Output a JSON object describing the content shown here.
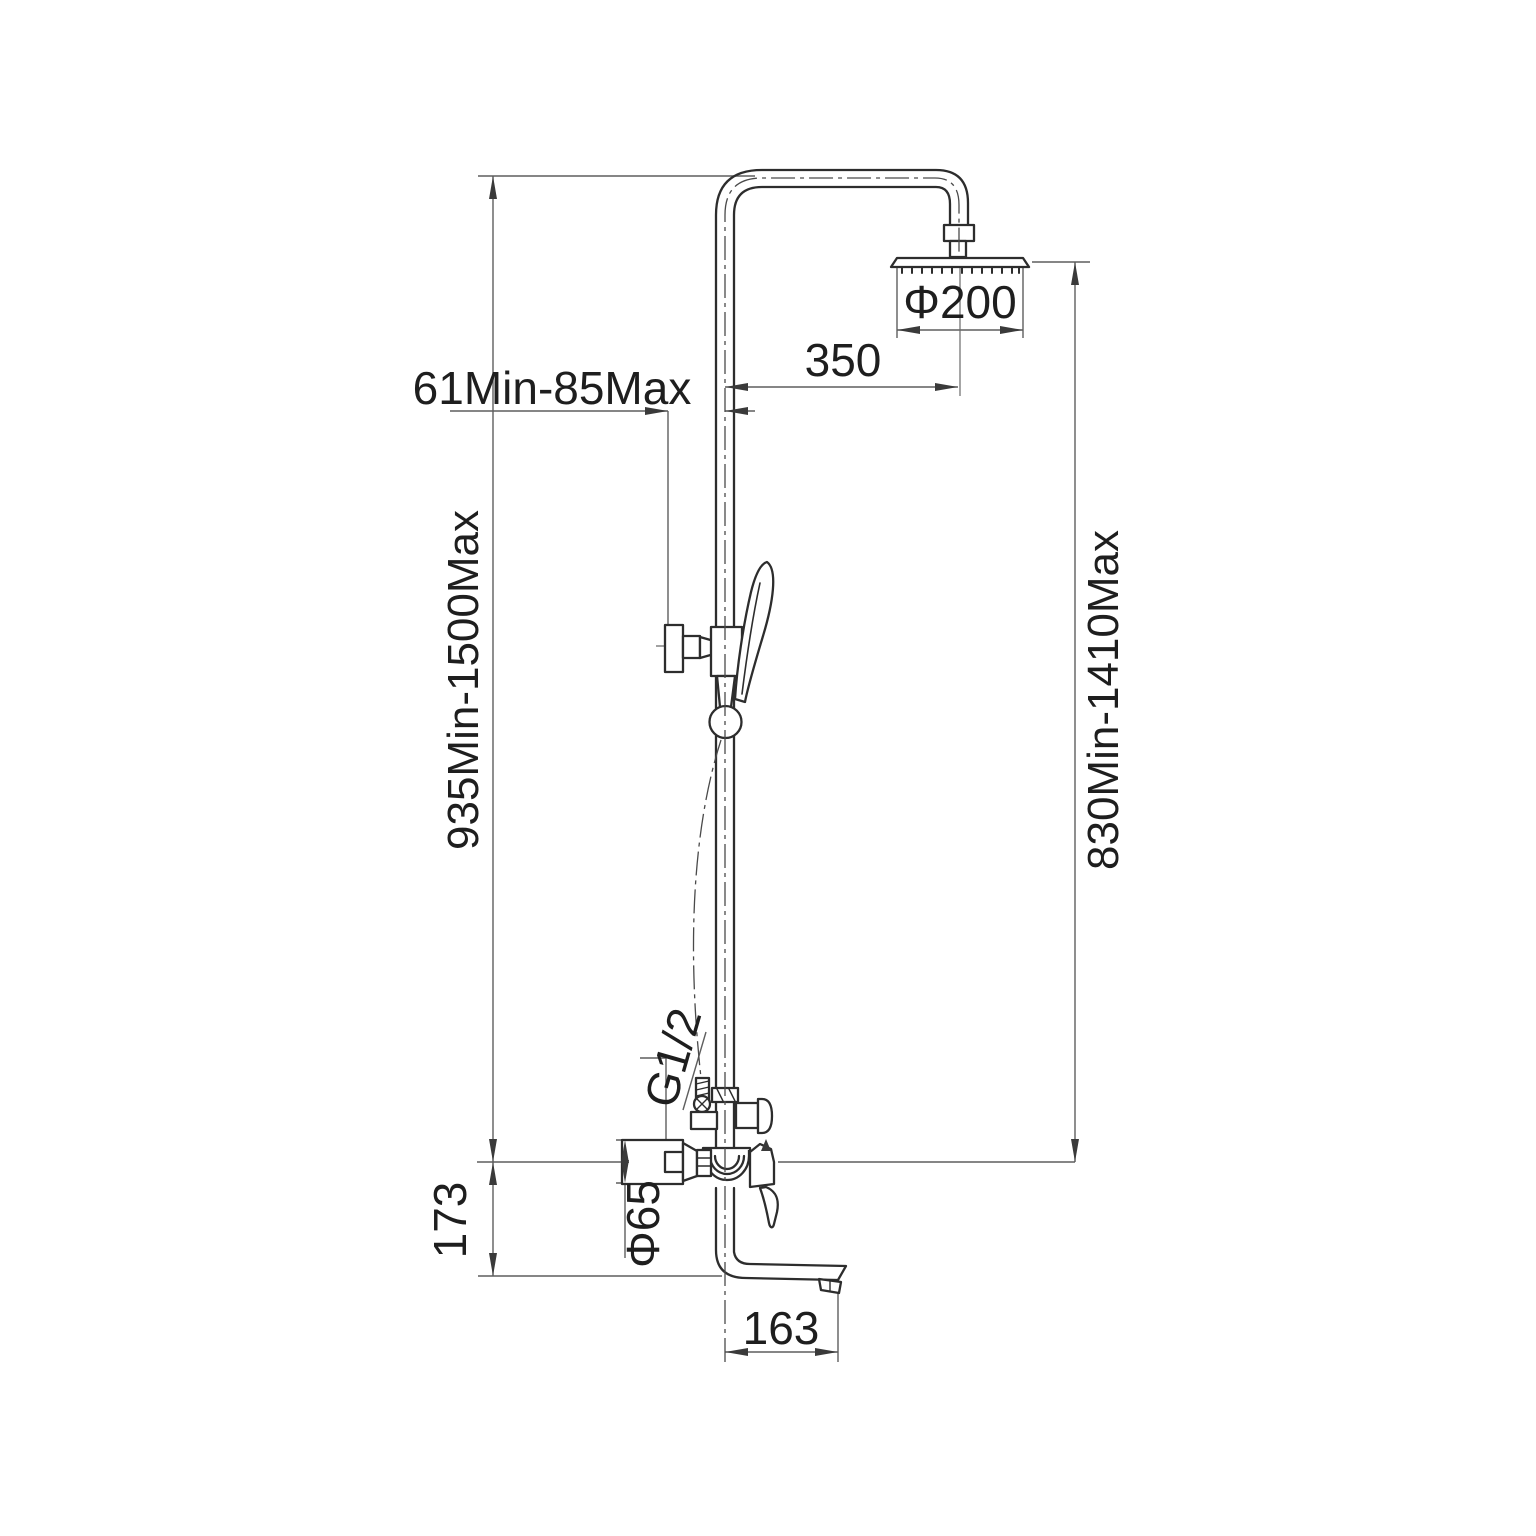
{
  "drawing": {
    "subject": "shower-column-dimension-drawing",
    "background": "#ffffff",
    "line_color": "#2d2d2d",
    "dim_color": "#5f5f5f",
    "labels": {
      "arm_reach": "350",
      "head_diameter": "Φ200",
      "wall_clearance": "61Min-85Max",
      "total_height": "935Min-1500Max",
      "head_to_mixer_height": "830Min-1410Max",
      "hose_thread": "G1/2",
      "escutcheon_diameter": "Φ65",
      "mixer_to_spout_drop": "173",
      "spout_reach": "163"
    }
  }
}
